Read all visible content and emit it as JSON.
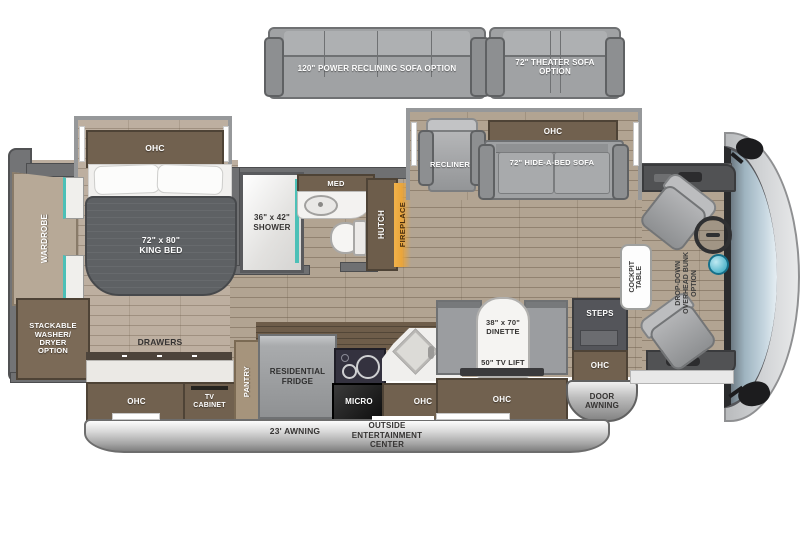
{
  "options": {
    "power_sofa_label": "120\" POWER RECLINING SOFA OPTION",
    "theater_sofa_line1": "72\" THEATER SOFA",
    "theater_sofa_line2": "OPTION"
  },
  "bedroom": {
    "ohc_label": "OHC",
    "bed_line1": "72\" x 80\"",
    "bed_line2": "KING BED",
    "wardrobe_label": "WARDROBE",
    "washer_line1": "STACKABLE",
    "washer_line2": "WASHER/",
    "washer_line3": "DRYER",
    "washer_line4": "OPTION",
    "drawers_label": "DRAWERS"
  },
  "bathroom": {
    "shower_line1": "36\" x 42\"",
    "shower_line2": "SHOWER",
    "med_label": "MED",
    "hutch_label": "HUTCH",
    "fireplace_label": "FIREPLACE"
  },
  "living": {
    "recliner_label": "RECLINER",
    "ohc_label": "OHC",
    "sofa_label": "72\" HIDE-A-BED SOFA"
  },
  "kitchen": {
    "ohc_left_label": "OHC",
    "tv_cabinet_line1": "TV",
    "tv_cabinet_line2": "CABINET",
    "pantry_label": "PANTRY",
    "fridge_line1": "RESIDENTIAL",
    "fridge_line2": "FRIDGE",
    "micro_label": "MICRO",
    "ohc_right_label": "OHC"
  },
  "dinette": {
    "size_line1": "38\" x 70\"",
    "size_line2": "DINETTE",
    "tv_lift_label": "50\" TV LIFT",
    "ohc_label": "OHC"
  },
  "entry": {
    "steps_label": "STEPS",
    "ohc_label": "OHC",
    "door_awning_line1": "DOOR",
    "door_awning_line2": "AWNING"
  },
  "cockpit": {
    "table_line1": "COCKPIT",
    "table_line2": "TABLE",
    "bunk_line1": "DROP-DOWN",
    "bunk_line2": "OVERHEAD BUNK",
    "bunk_line3": "OPTION"
  },
  "exterior": {
    "awning_label": "23' AWNING",
    "oec_line1": "OUTSIDE",
    "oec_line2": "ENTERTAINMENT",
    "oec_line3": "CENTER"
  },
  "colors": {
    "accent_teal": "#4cc0b7",
    "fireplace_glow": "#eca93c",
    "wood_floor": "#b2a492",
    "wall_gray": "#6f7072",
    "cabinet_brown": "#71614f",
    "windshield_blue": "#b8cad6"
  }
}
